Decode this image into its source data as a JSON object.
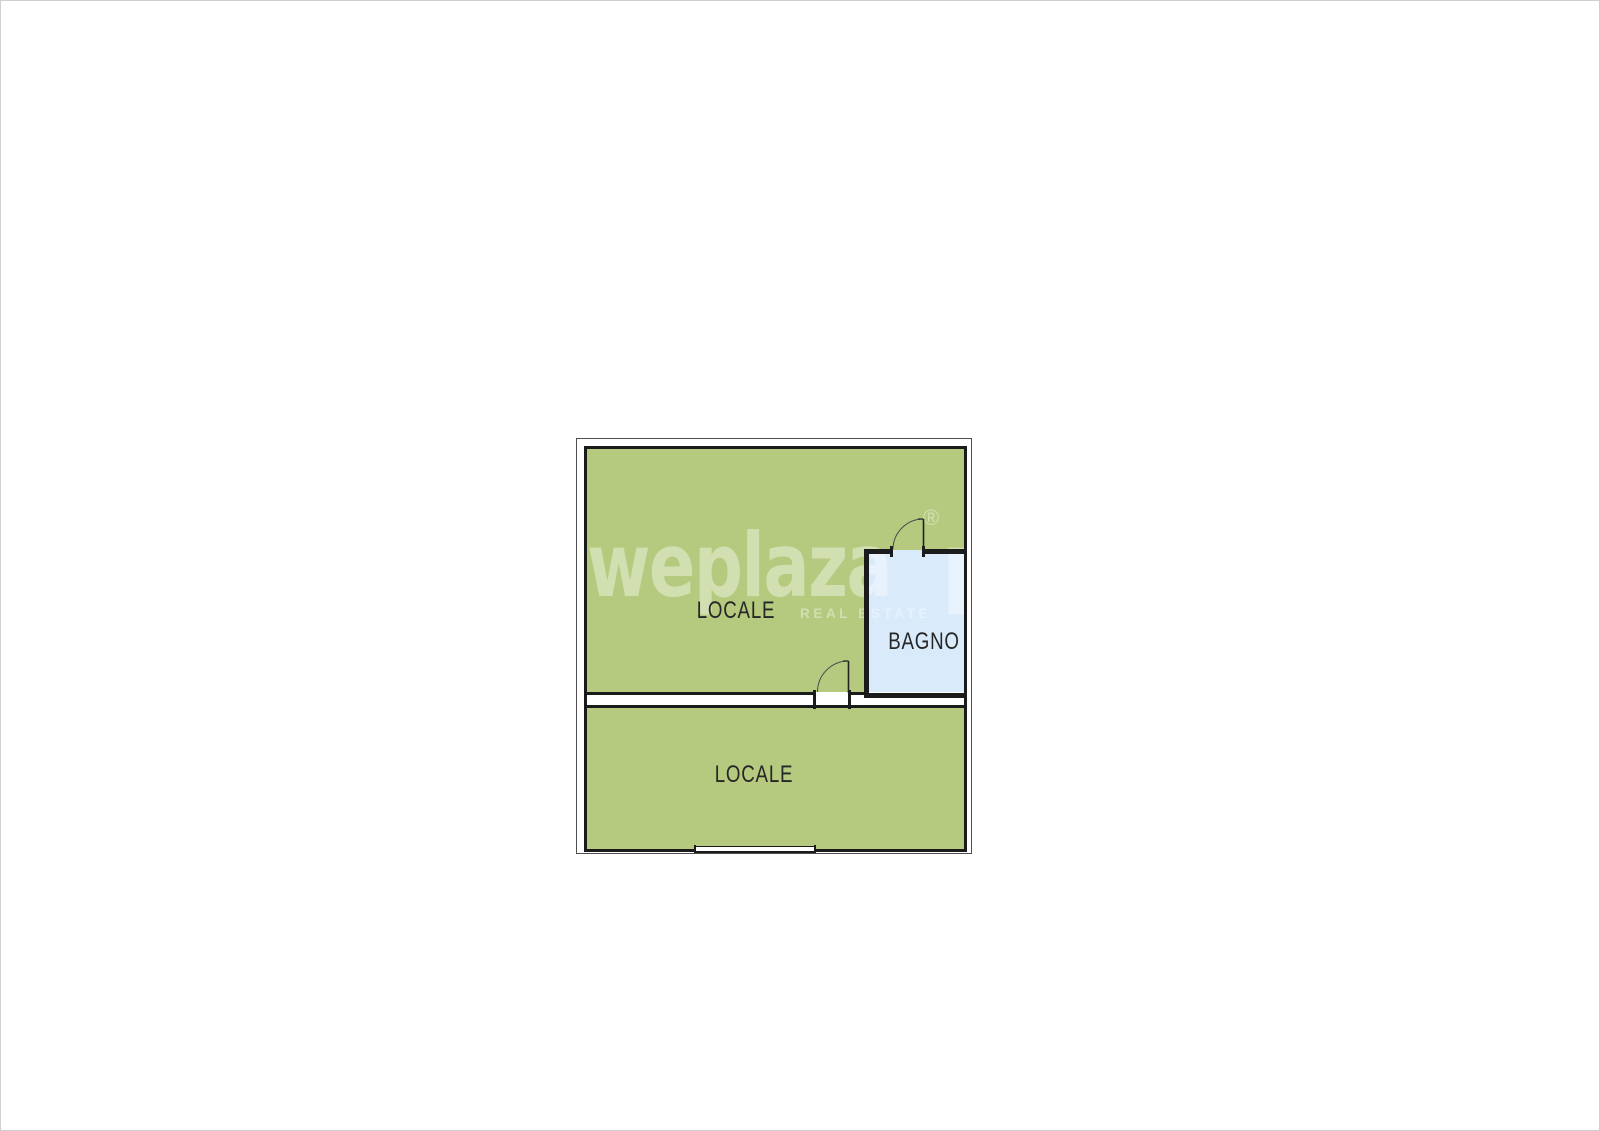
{
  "page": {
    "background": "#ffffff",
    "border_color": "#cfcfcf"
  },
  "floorplan": {
    "wall_color": "#1b1b1b",
    "outline_color": "#4f4f4f",
    "label_color": "#262626",
    "rooms": [
      {
        "id": "locale-upper",
        "label": "LOCALE",
        "fill": "#b5ca7e"
      },
      {
        "id": "locale-lower",
        "label": "LOCALE",
        "fill": "#b5ca7e"
      },
      {
        "id": "bagno",
        "label": "BAGNO",
        "fill": "#d9eafb"
      }
    ],
    "doors": [
      {
        "id": "door-bagno",
        "location": "bagno top wall, swings into upper locale"
      },
      {
        "id": "door-middle",
        "location": "wall between upper and lower locale, swings into upper locale"
      }
    ],
    "openings": [
      {
        "id": "window-bottom",
        "location": "bottom exterior wall of lower locale"
      }
    ]
  },
  "watermark": {
    "brand": "weplaza",
    "registered": "®",
    "partial_glyph": "p",
    "tagline": "REAL ESTATE",
    "color": "rgba(255,255,255,0.40)"
  }
}
